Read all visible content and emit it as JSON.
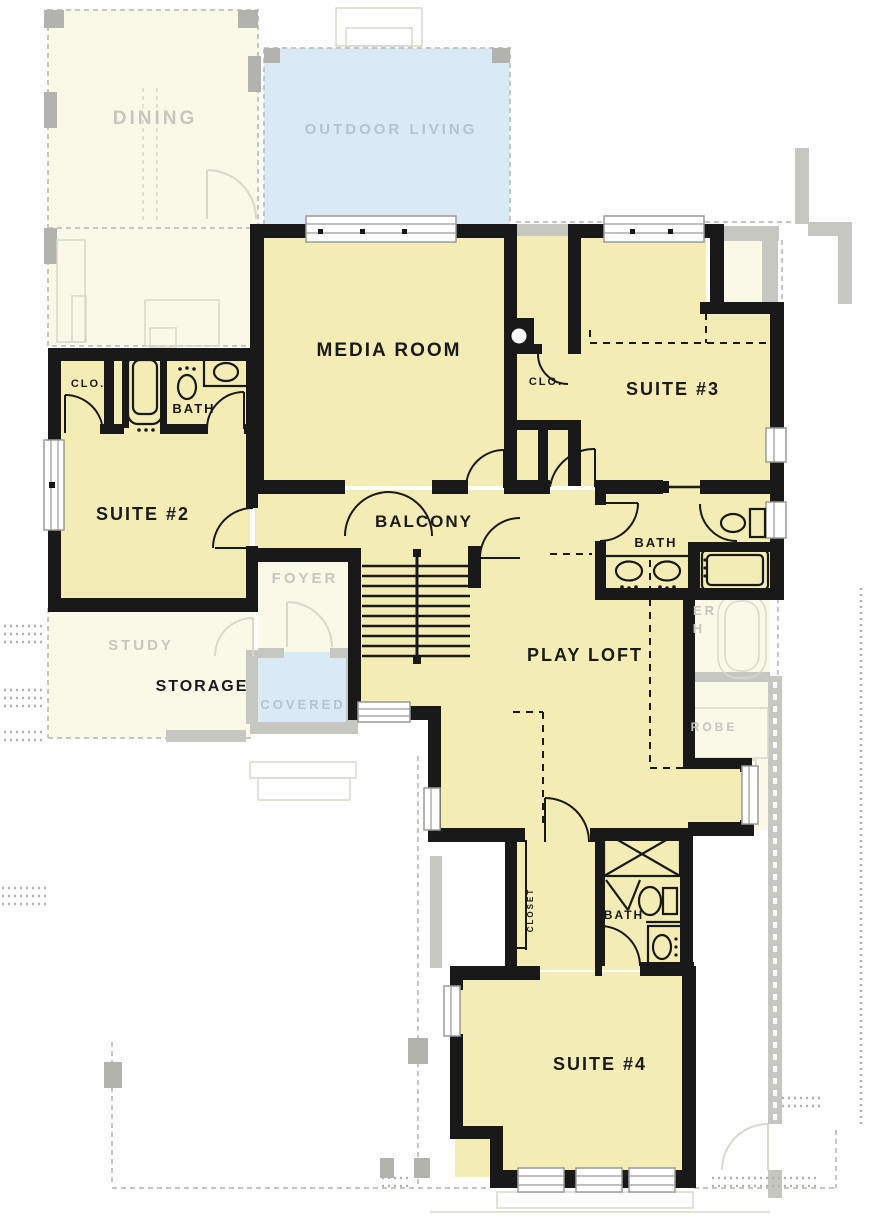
{
  "colors": {
    "page_bg": "#FFFFFF",
    "active_room_fill": "#F3ECB5",
    "ghost_room_fill": "#FAF8E7",
    "outdoor_fill": "#D9E9F6",
    "wall": "#191919",
    "ghost_wall": "#C7C7C2",
    "ghost_post": "#B3B3AE",
    "ghost_line": "#D8D8CC",
    "ghost_text": "#C6C6BE",
    "outdoor_text": "#B3C3CF",
    "active_text": "#1A1A1A",
    "window_frame": "#9A9A96"
  },
  "labels": {
    "dining": "DINING",
    "outdoor_living": "OUTDOOR LIVING",
    "media_room": "MEDIA ROOM",
    "suite2": "SUITE #2",
    "suite3": "SUITE #3",
    "suite4": "SUITE #4",
    "clo_suite2": "CLO.",
    "clo_suite3": "CLO.",
    "bath_suite2": "BATH",
    "bath_suite3": "BATH",
    "bath_suite4": "BATH",
    "balcony": "BALCONY",
    "foyer": "FOYER",
    "study": "STUDY",
    "storage": "STORAGE",
    "covered": "COVERED",
    "play_loft": "PLAY LOFT",
    "closet": "CLOSET",
    "ghost_fragment_er": "ER",
    "ghost_fragment_h": "H",
    "ghost_fragment_robe": "ROBE"
  }
}
